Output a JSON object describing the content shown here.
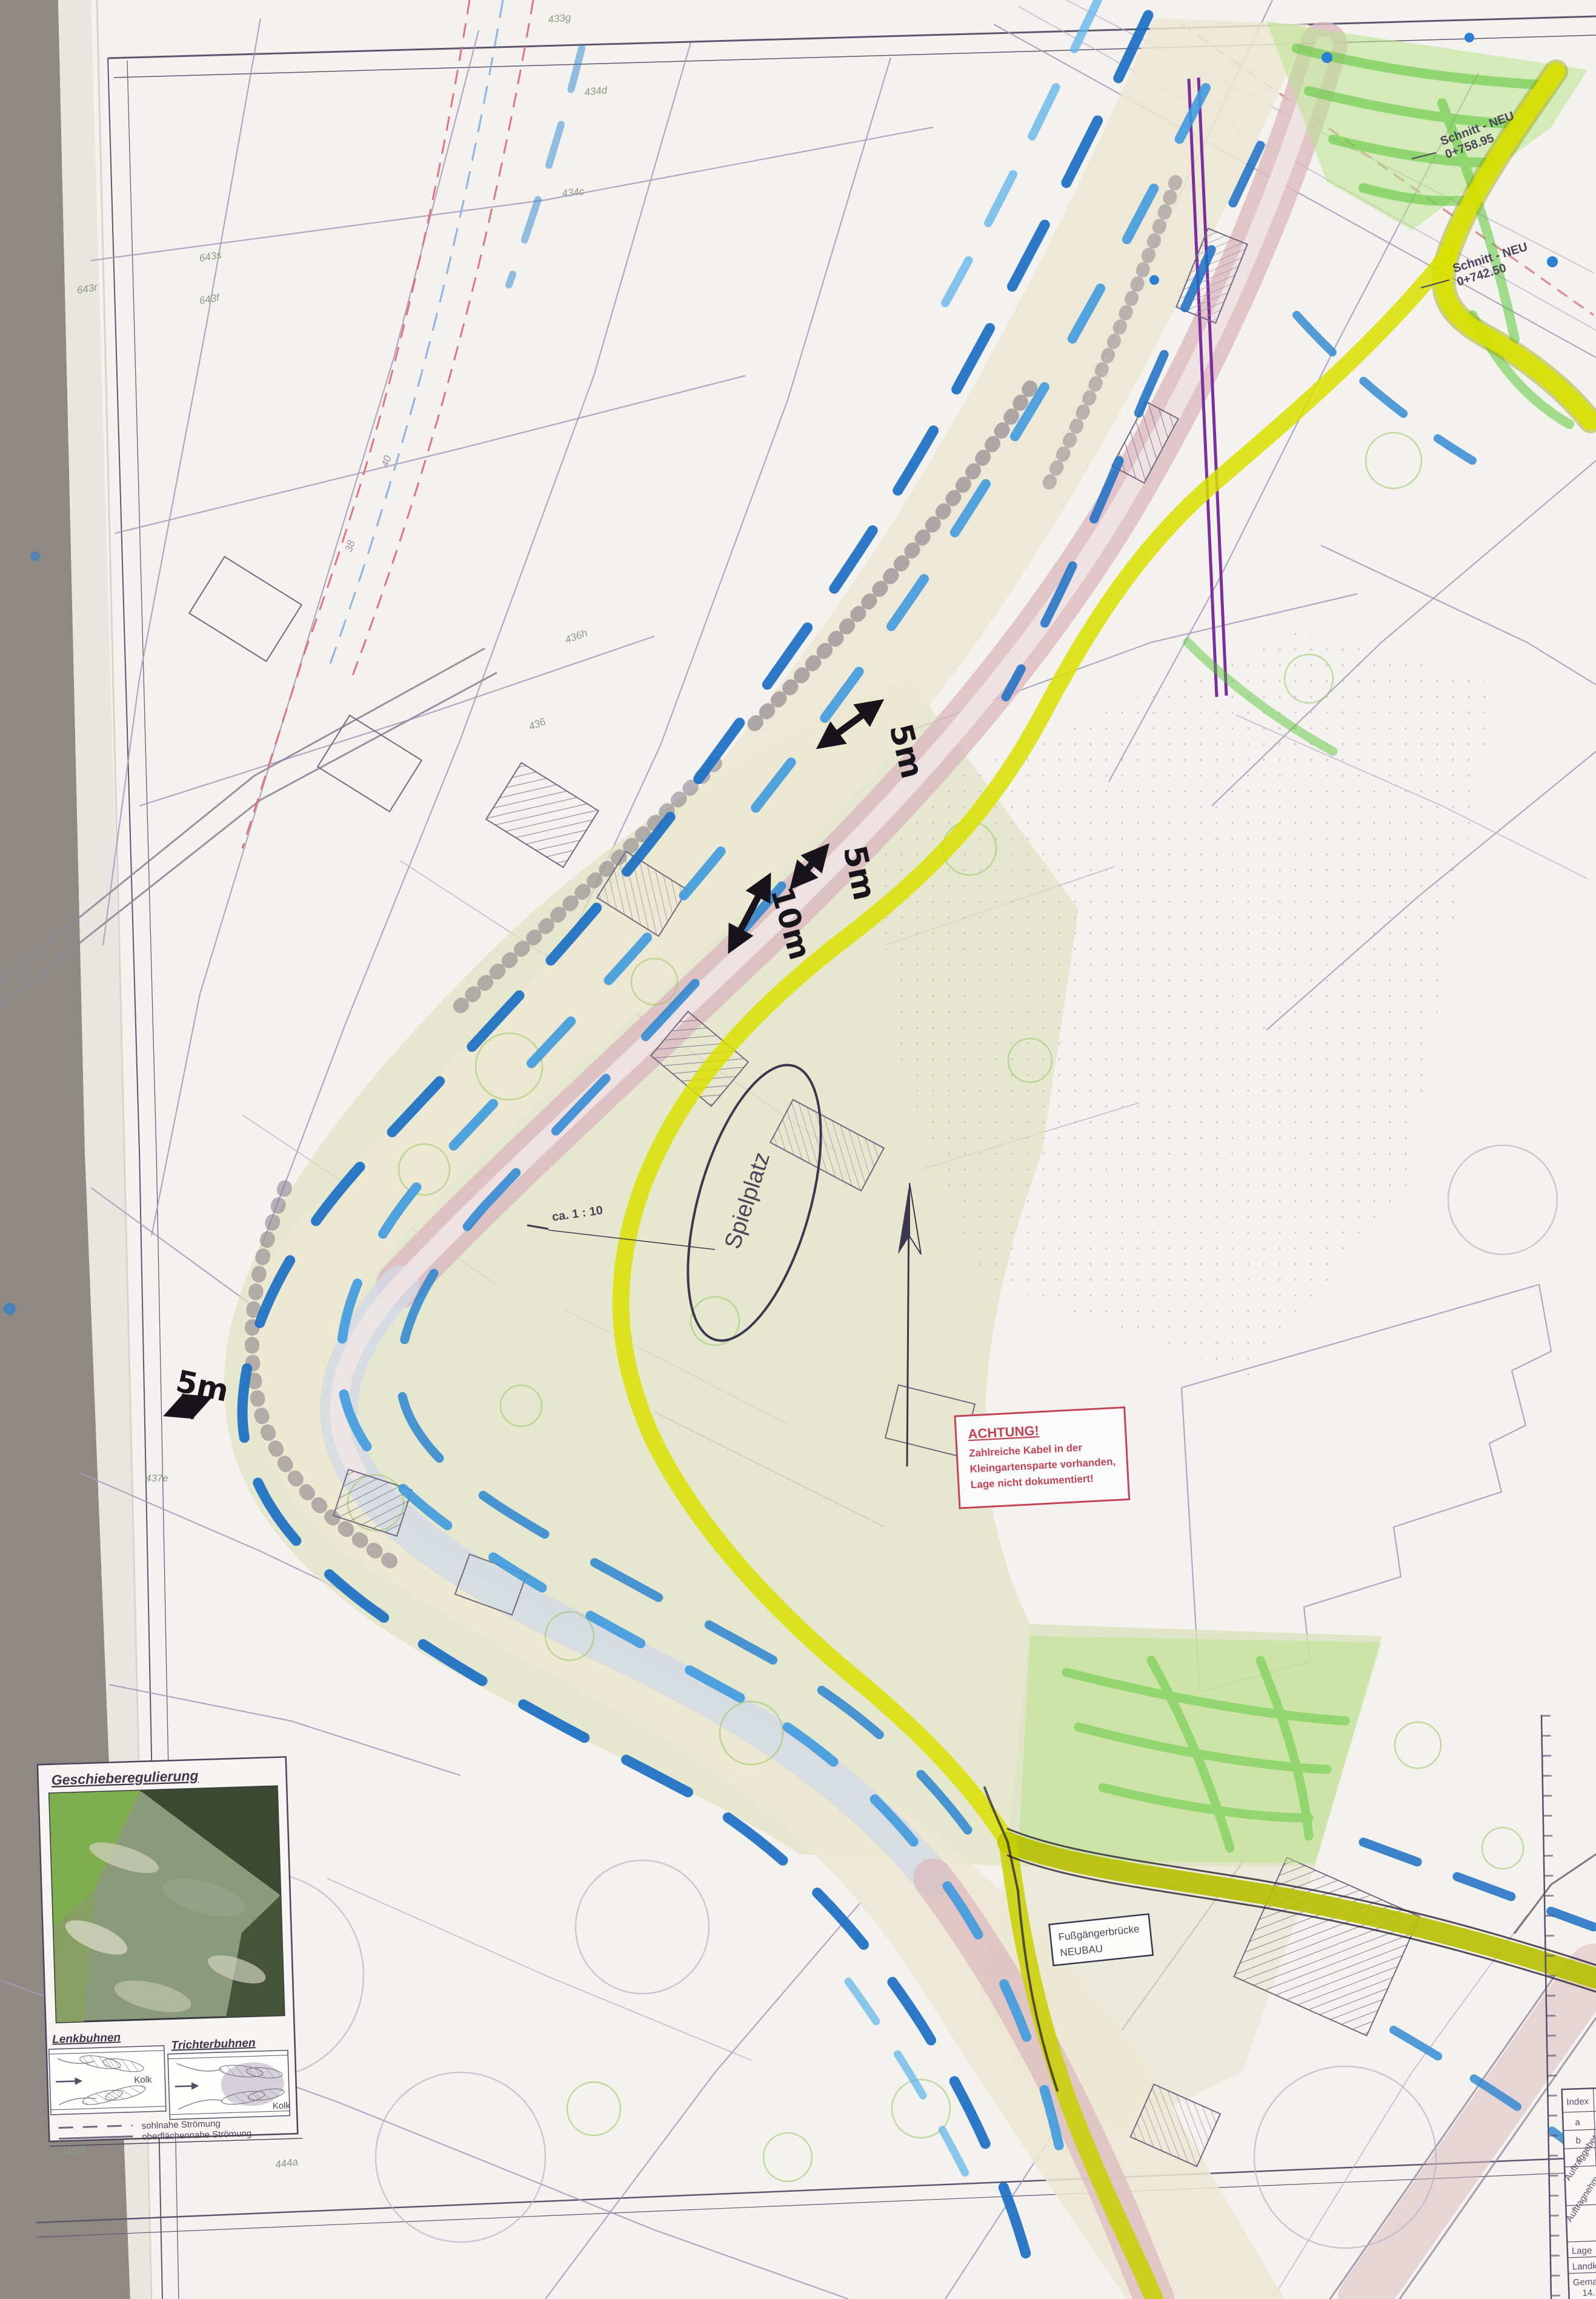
{
  "labels": {
    "spielplatz": "Spielplatz",
    "scale_note": "ca. 1 : 10",
    "schnitt1_l1": "Schnitt - NEU",
    "schnitt1_l2": "0+758.95",
    "schnitt2_l1": "Schnitt - NEU",
    "schnitt2_l2": "0+742.50",
    "bridge_l1": "Fußgängerbrücke",
    "bridge_l2": "NEUBAU"
  },
  "warning": {
    "title": "ACHTUNG!",
    "line1": "Zahlreiche Kabel in der",
    "line2": "Kleingartensparte vorhanden,",
    "line3": "Lage nicht dokumentiert!"
  },
  "annotations": {
    "dim_top": "5m",
    "dim_mid": "5m",
    "dim_ten": "10m",
    "dim_left": "5m"
  },
  "legend": {
    "title": "Geschieberegulierung",
    "diagram_left": "Lenkbuhnen",
    "diagram_right": "Trichterbuhnen",
    "kolk_left": "Kolk",
    "kolk_right": "Kolk",
    "flow1": "sohlnahe Strömung",
    "flow2": "oberflächennahe Strömung"
  },
  "parcels": [
    "433g",
    "434d",
    "434c",
    "40",
    "38",
    "436h",
    "436",
    "437e",
    "643s",
    "643r",
    "643f",
    "445/4",
    "444a"
  ],
  "titleblock": {
    "rows": [
      "Index",
      "a",
      "b",
      "c",
      "Auftraggeber",
      "Auftragnehmer",
      "Lage",
      "Landkreis",
      "Gemarkung",
      "14.10."
    ]
  },
  "colors": {
    "marker_blue_dark": "#1b6fc4",
    "marker_blue": "#3f9ade",
    "marker_blue_light": "#66b7ea",
    "marker_yellow": "#d9e100",
    "marker_green": "#4ec32a",
    "channel_pink": "#dcb9bf",
    "warning_red": "#c24456",
    "rail_purple": "#7b2f9e",
    "paper": "#f4f2ef",
    "desk": "#8e8983"
  }
}
